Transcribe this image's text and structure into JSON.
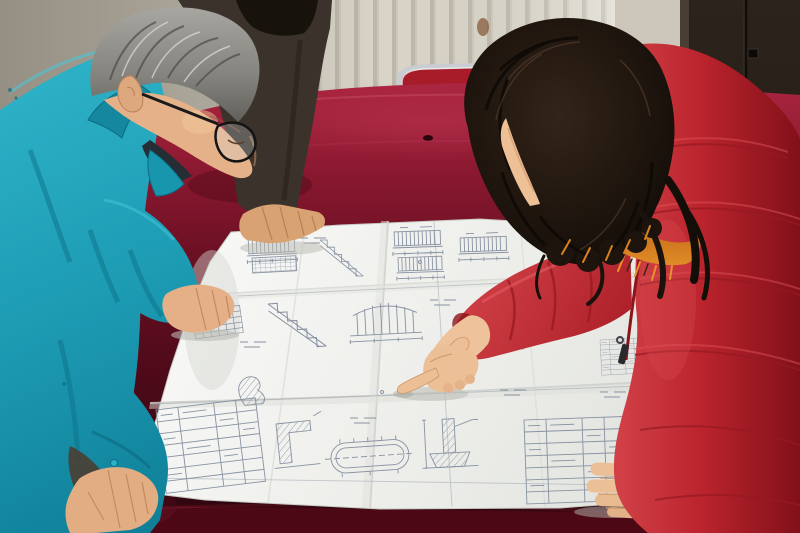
{
  "meta": {
    "type": "photograph",
    "alt": "Three people gather around a table draped in dark red velvet to examine a large unfolded engineering blueprint; an older man in a teal work jacket and glasses leans over the sheet while a woman in a red down coat with an orange fur-trimmed hood points at a detail with her index finger.",
    "setting": "Interior room with a cream radiator wall on the left and a dark brown door on the right."
  },
  "scene": {
    "background": {
      "wall": {
        "label": "plaster wall",
        "color": "#aba69a"
      },
      "radiator": {
        "label": "radiator panel with vertical fins",
        "color": "#d9d5c9",
        "fin_color": "#bdb8ab",
        "stain_color": "#7a4a28"
      },
      "door": {
        "label": "dark wooden door",
        "color": "#241d17",
        "frame_color": "#4a3e33",
        "latch_color": "#0c0906"
      }
    },
    "furniture": {
      "table": {
        "label": "table covered with dark red velvet cloth",
        "cloth_color": "#6f0f24",
        "sheen_color": "#ab2540",
        "shadow_color": "#330610"
      },
      "chair": {
        "label": "red chair with chrome tube frame",
        "seat_color": "#a81b28",
        "frame_color": "#c9ccd0"
      }
    },
    "blueprint": {
      "label": "folded engineering drawing sheet",
      "paper_color": "#f2f3f0",
      "ink_color": "#8892a2",
      "features": [
        "elevation views",
        "stair sections",
        "hatched wall details",
        "dimension lines",
        "title block table",
        "oval duct detail",
        "column footing detail",
        "fold creases"
      ]
    },
    "people": [
      {
        "id": "man-left",
        "description": "Middle-aged man with gray hair and black-framed glasses, wearing a teal work jacket, both hands on the drawing, head bowed in study",
        "jacket_color": "#1d9cb4",
        "hair_color": "#8a8a85",
        "skin_color": "#e8b68c"
      },
      {
        "id": "person-behind",
        "description": "Partially visible person in a dark jacket resting one hand on the top edge of the drawing",
        "jacket_color": "#3b332b",
        "hair_color": "#18120d"
      },
      {
        "id": "woman-right",
        "description": "Woman with long dark wavy hair wearing a red down coat with orange fur-trimmed hood, pointing at the blueprint with her right index finger, left hand resting on the sheet",
        "coat_color": "#c3242e",
        "fur_color": "#c8701a",
        "hair_color": "#241a13",
        "skin_color": "#ecc097"
      }
    ],
    "palette": {
      "velvet_dark": "#3f0813",
      "velvet_mid": "#6f0f24",
      "teal": "#1d9cb4",
      "coat_red": "#c3242e",
      "paper": "#f2f3f0",
      "wall": "#aaa59a",
      "door": "#241d17",
      "skin": "#e8b68c"
    }
  }
}
